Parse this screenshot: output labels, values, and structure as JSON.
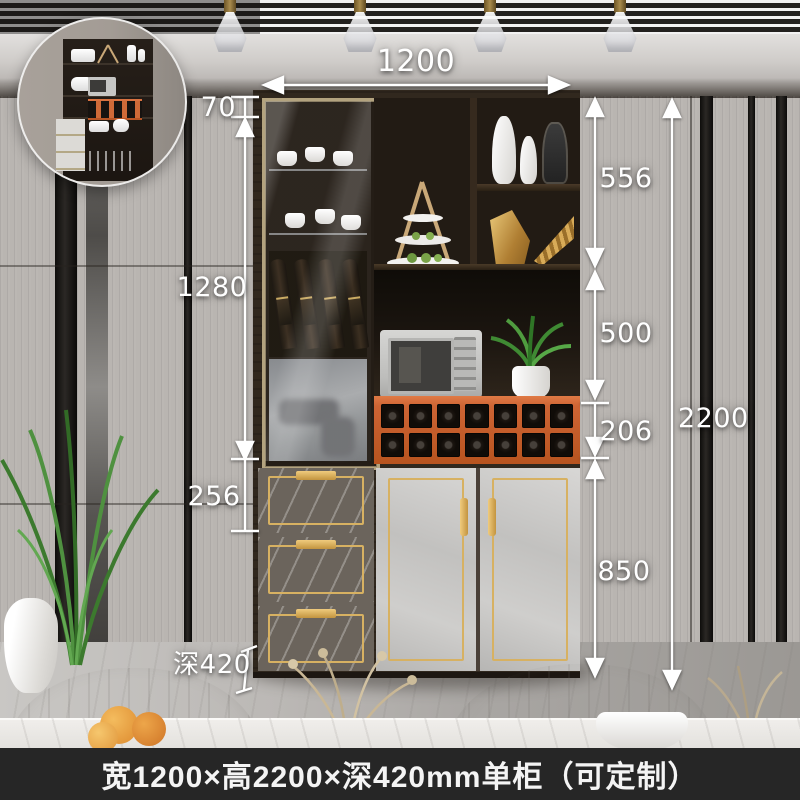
{
  "dims": {
    "width": "1200",
    "top_gap": "70",
    "glass_section": "1280",
    "mirror_section": "256",
    "shelf_section": "556",
    "niche_section": "500",
    "rack_section": "206",
    "base_section": "850",
    "total_height": "2200",
    "depth": "深420"
  },
  "caption": "宽1200×高2200×深420mm单柜（可定制）",
  "colors": {
    "rack_orange": "#cd6434",
    "gold_trim": "#d7b162",
    "annotation": "#ffffff",
    "caption_bg": "#262626"
  }
}
